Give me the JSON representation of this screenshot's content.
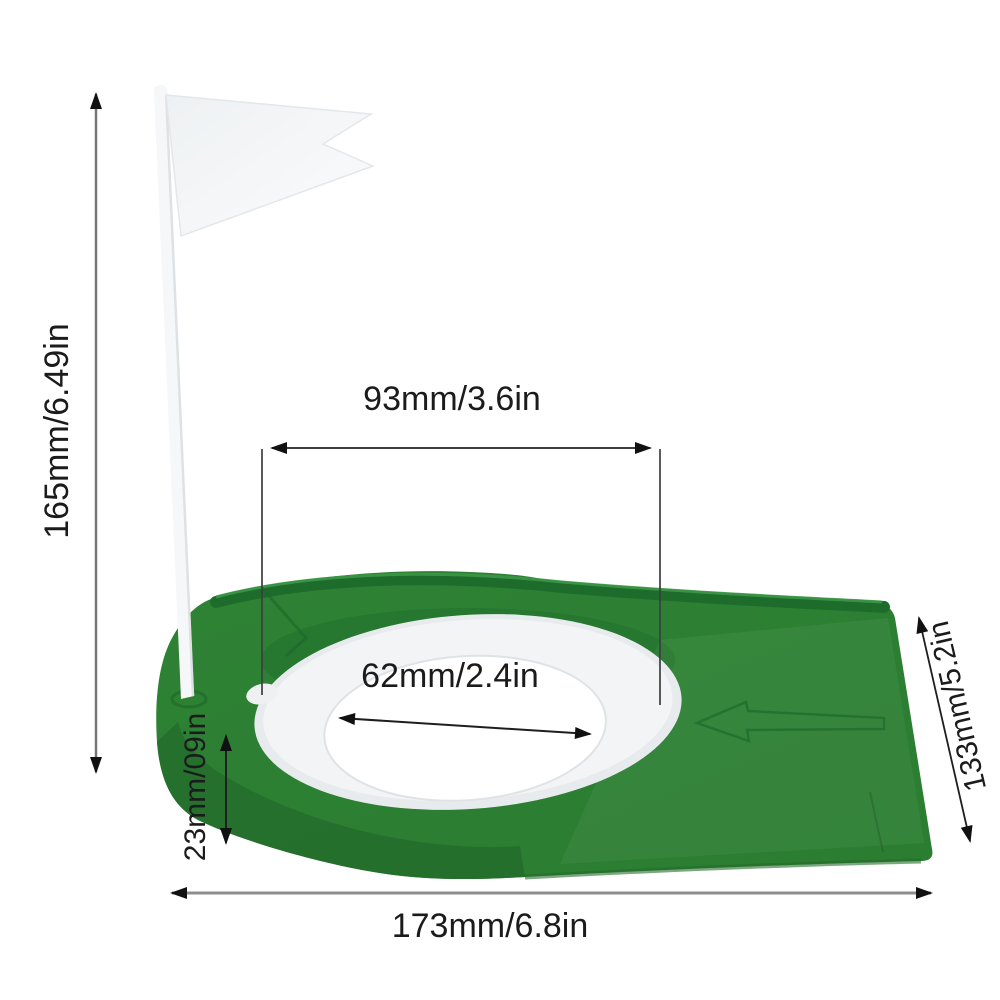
{
  "dimensions": {
    "pole_height": "165mm/6.49in",
    "top_width": "93mm/3.6in",
    "hole_diameter": "62mm/2.4in",
    "base_height": "23mm/09in",
    "base_depth": "133mm/5.2in",
    "base_width": "173mm/6.8in"
  },
  "colors": {
    "base_green": "#2e8234",
    "base_green_dark": "#1f6c2b",
    "base_green_light": "#43a04f",
    "ring_gray": "#e8ebed",
    "hole_white": "#ffffff",
    "flag_white": "#f2f4f6",
    "dim_line_dark": "#3e3e3e",
    "dim_line_gray": "#8e8e8e",
    "arrowhead": "#111111"
  },
  "figure": {
    "flag": "white-pennant-flag",
    "pole": "white-flag-pole",
    "base": "green-putting-cup-base",
    "ring": "white-hole-collar",
    "hole": "putting-hole",
    "molded_arrow": "embossed-left-arrow"
  }
}
